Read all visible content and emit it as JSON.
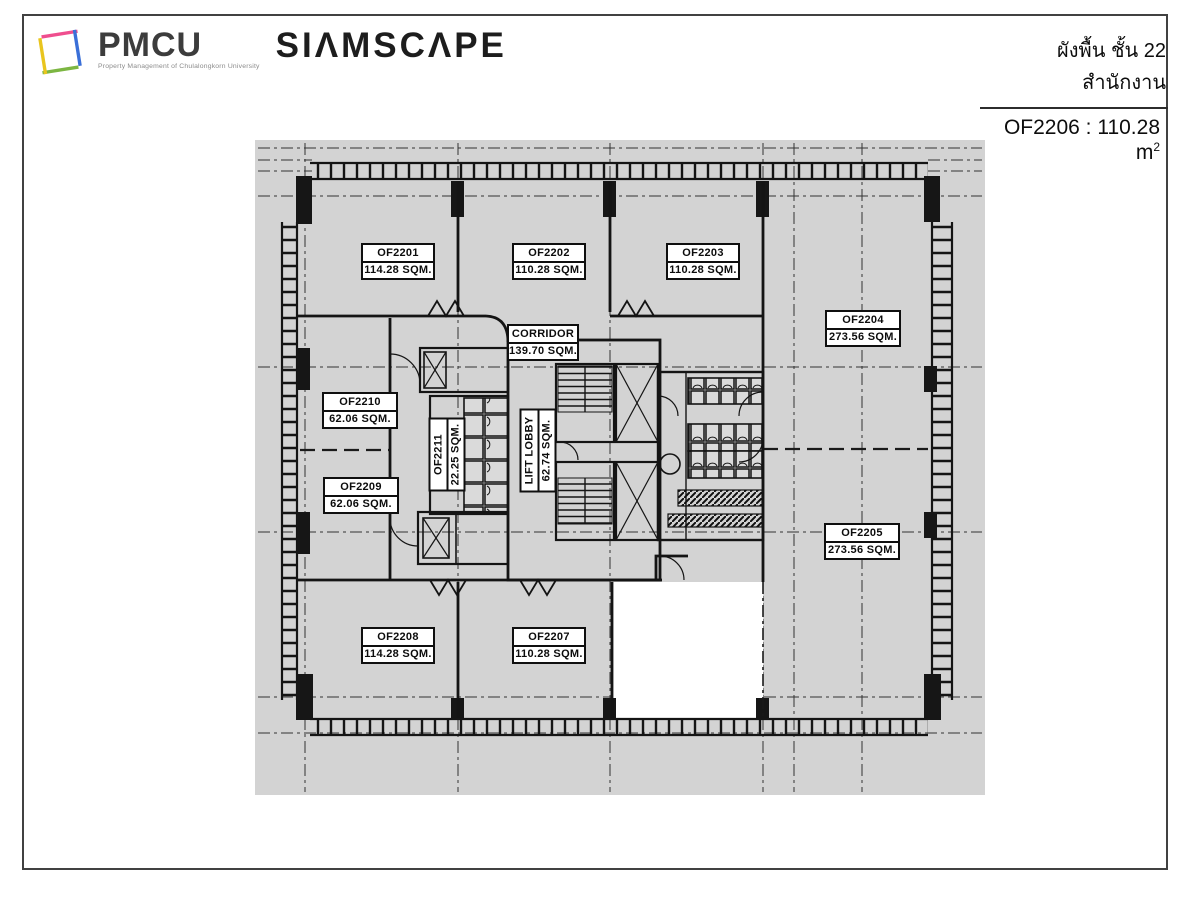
{
  "header": {
    "logo": {
      "brand_acronym": "PMCU",
      "brand_sub": "Property Management of Chulalongkorn University",
      "brand_name": "SIΛMSCΛPE"
    },
    "title_thai": "ผังพื้น ชั้น 22 สำนักงาน",
    "highlight_text": "OF2206 : 110.28 m",
    "highlight_sup": "2"
  },
  "plan": {
    "units": {
      "of2201": {
        "id": "OF2201",
        "area": "114.28 SQM."
      },
      "of2202": {
        "id": "OF2202",
        "area": "110.28 SQM."
      },
      "of2203": {
        "id": "OF2203",
        "area": "110.28 SQM."
      },
      "of2204": {
        "id": "OF2204",
        "area": "273.56 SQM."
      },
      "of2205": {
        "id": "OF2205",
        "area": "273.56 SQM."
      },
      "of2207": {
        "id": "OF2207",
        "area": "110.28 SQM."
      },
      "of2208": {
        "id": "OF2208",
        "area": "114.28 SQM."
      },
      "of2209": {
        "id": "OF2209",
        "area": "62.06 SQM."
      },
      "of2210": {
        "id": "OF2210",
        "area": "62.06 SQM."
      },
      "of2211": {
        "id": "OF2211",
        "area": "22.25 SQM."
      },
      "corridor": {
        "id": "CORRIDOR",
        "area": "139.70 SQM."
      },
      "lift_lobby": {
        "id": "LIFT LOBBY",
        "area": "62.74 SQM."
      }
    },
    "colors": {
      "plan_bg": "#d3d3d3",
      "line": "#141414",
      "highlight_bg": "#ffffff"
    }
  }
}
